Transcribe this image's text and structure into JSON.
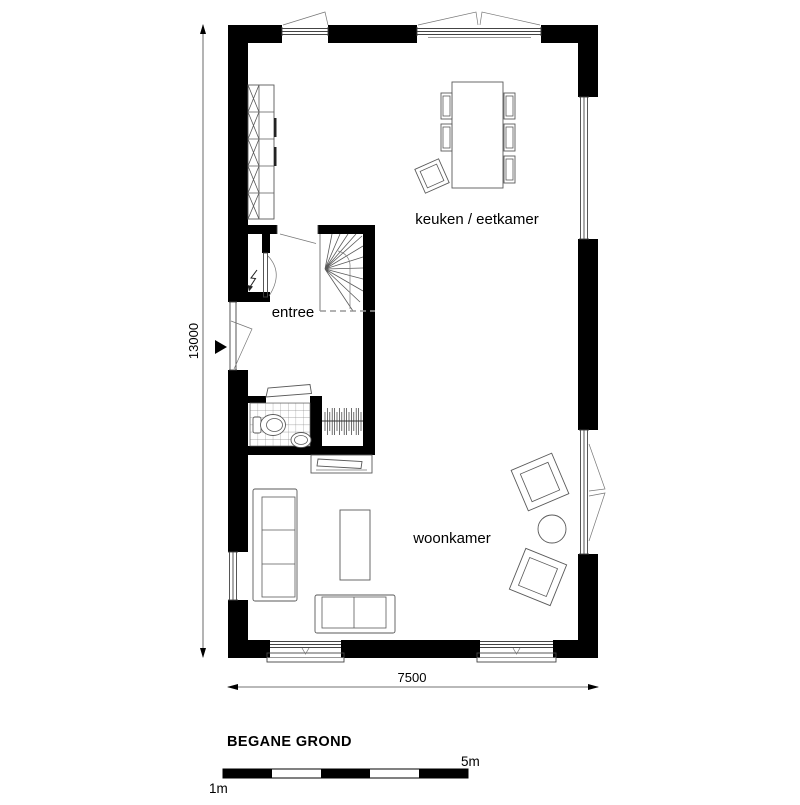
{
  "title": "BEGANE GROND",
  "rooms": {
    "kitchen_dining": "keuken / eetkamer",
    "entrance": "entree",
    "living": "woonkamer"
  },
  "dimensions": {
    "height_mm": "13000",
    "width_mm": "7500"
  },
  "scale_bar": {
    "min_label": "1m",
    "max_label": "5m"
  },
  "colors": {
    "wall": "#000000",
    "background": "#ffffff",
    "line": "#444444"
  }
}
